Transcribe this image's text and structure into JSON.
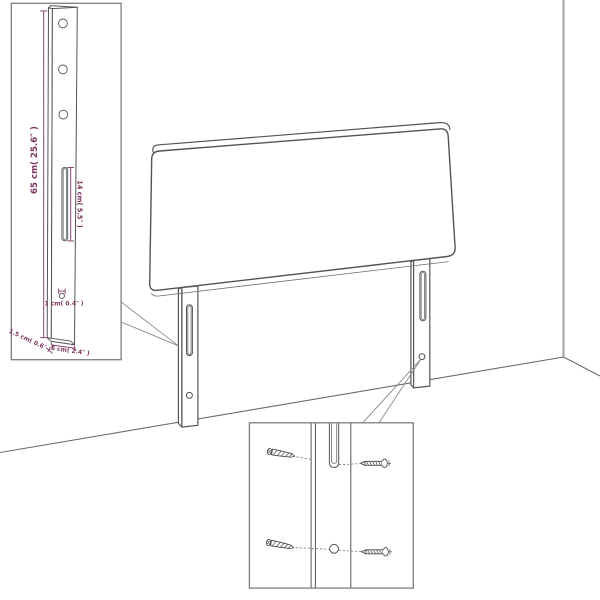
{
  "diagram": {
    "title_note": "headboard assembly diagram",
    "measurements": {
      "post_height": "65 cm( 25.6″ )",
      "slot_length": "14 cm( 5.5″ )",
      "hole_diameter": "1 cm( 0.4″ )",
      "post_thickness": "1.5 cm( 0.6″ )",
      "post_width": "6 cm( 2.4″ )"
    },
    "colors": {
      "background": "#ffffff",
      "line_art": "#545454",
      "room_lines": "#a3a3a3",
      "dimension_accent": "#7b3460",
      "inset_border": "#7d7d7d"
    }
  }
}
